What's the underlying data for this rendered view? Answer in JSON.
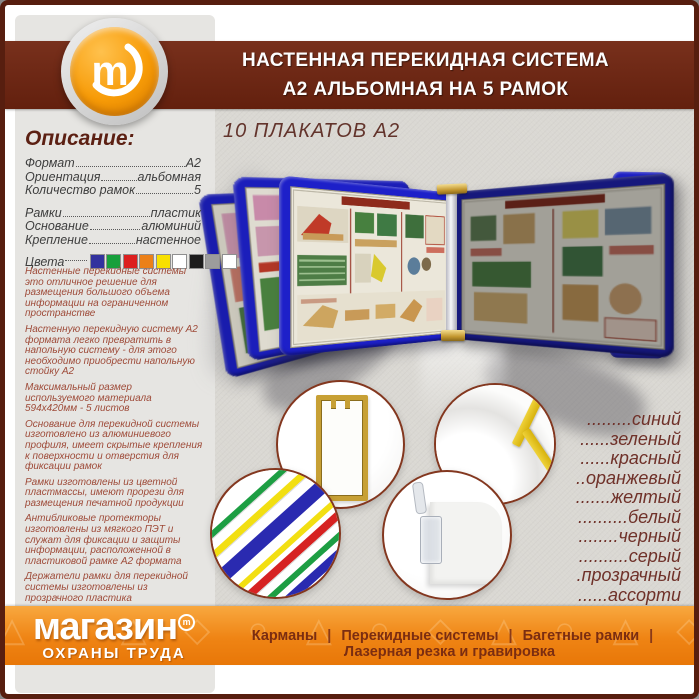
{
  "header": {
    "title_line1": "НАСТЕННАЯ ПЕРЕКИДНАЯ СИСТЕМА",
    "title_line2": "А2 АЛЬБОМНАЯ НА 5 РАМОК"
  },
  "logo": {
    "letter": "m"
  },
  "sidebar": {
    "heading": "Описание:",
    "specs": [
      {
        "label": "Формат",
        "value": "А2"
      },
      {
        "label": "Ориентация",
        "value": "альбомная"
      },
      {
        "label": "Количество рамок",
        "value": "5"
      },
      {
        "label": "Рамки",
        "value": "пластик"
      },
      {
        "label": "Основание",
        "value": "алюминий"
      },
      {
        "label": "Крепление",
        "value": "настенное"
      }
    ],
    "colors_label": "Цвета",
    "swatches": [
      "#32329e",
      "#17a03c",
      "#dc1f1f",
      "#ec8018",
      "#f8e000",
      "#ffffff",
      "#1c1c1c",
      "#9c9c9c",
      "#ffffff"
    ],
    "bullets": [
      "Настенные перекидные системы это отличное решение для размещения большого объема информации на ограниченном пространстве",
      "Настенную перекидную систему А2 формата легко превратить в напольную систему - для этого необходимо приобрести напольную стойку А2",
      "Максимальный размер используемого материала 594х420мм - 5 листов",
      "Основание для перекидной системы изготовлено из алюминиевого профиля, имеет скрытые крепления к поверхности и отверстия для фиксации рамок",
      "Рамки изготовлены из цветной пластмассы, имеют прорези для размещения печатной продукции",
      "Антибликовые протекторы изготовлены из мягкого ПЭТ и служат для фиксации и защиты информации, расположенной в пластиковой рамке А2 формата",
      "Держатели рамки для перекидной системы изготовлены из прозрачного пластика",
      "Изготавливаем настенные, настольные и напольные перекидные системы А4, А3 и А2 формата на любое количество рамок"
    ]
  },
  "main": {
    "subtitle": "10 ПЛАКАТОВ А2",
    "color_list": [
      ".........синий",
      "......зеленый",
      "......красный",
      "..оранжевый",
      ".......желтый",
      "..........белый",
      "........черный",
      "..........серый",
      ".прозрачный",
      "......ассорти"
    ]
  },
  "brand": {
    "name": "магазин",
    "tm": "m",
    "subname": "ОХРАНЫ ТРУДА"
  },
  "footer": {
    "menu": [
      "Карманы",
      "Перекидные системы",
      "Багетные рамки",
      "Лазерная резка и гравировка"
    ],
    "separator": "|",
    "watermark_glyphs": "△ ○ △ ◇ ○ △ ○ ◇ △ ○ △ ◇ ○ △ ○ △ ◇ △"
  },
  "colors": {
    "border_maroon": "#571e0f",
    "header_maroon": "#6b2715",
    "footer_orange": "#ef8414",
    "frame_blue": "#1d20c9",
    "logo_orange": "#f79b07"
  }
}
